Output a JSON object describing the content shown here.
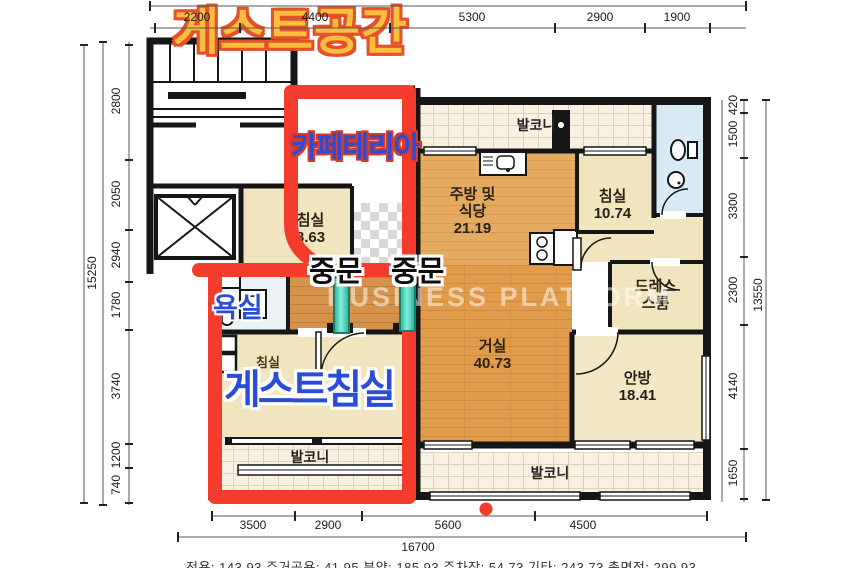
{
  "title": "게스트공간",
  "overlay": {
    "cafeteria": "카페테리아",
    "guest_bath": "욕실",
    "guest_bedroom": "게스트침실",
    "door1": "중문",
    "door2": "중문"
  },
  "watermark": "BUSINESS PLATFORM",
  "rooms": {
    "balcony_top": "발코니",
    "kitchen": {
      "name1": "주방 및",
      "name2": "식당",
      "area": "21.19"
    },
    "bedroom2": {
      "name": "침실",
      "area": "10.74"
    },
    "dressroom": {
      "name1": "드레스",
      "name2": "스룸"
    },
    "living": {
      "name": "거실",
      "area": "40.73"
    },
    "master": {
      "name": "안방",
      "area": "18.41"
    },
    "bedroom1": {
      "name": "침실",
      "area": "8.63"
    },
    "bedroom_guest_orig": "침실",
    "balcony_bottom": "발코니",
    "balcony_guest": "발코니"
  },
  "dims": {
    "top": [
      "2200",
      "4400",
      "5300",
      "2900",
      "1900"
    ],
    "left": [
      "2800",
      "2050",
      "2940",
      "1780",
      "3740",
      "1200",
      "740"
    ],
    "left_total": "15250",
    "right": [
      "420",
      "1500",
      "3300",
      "2300",
      "4140",
      "1650"
    ],
    "right_total": "13550",
    "bottom": [
      "3500",
      "2900",
      "5600",
      "4500"
    ],
    "bottom_total": "16700"
  },
  "footer": "전용: 143.93  주거공용: 41.95  분양: 185.93  주차장: 54.73  기타: 243.73  총면적: 299.93",
  "colors": {
    "annotation_red": "#f43b2c",
    "title_yellow": "#fcbe3e",
    "overlay_blue": "#2b4cd8",
    "door_teal": "#3fd2b8"
  }
}
